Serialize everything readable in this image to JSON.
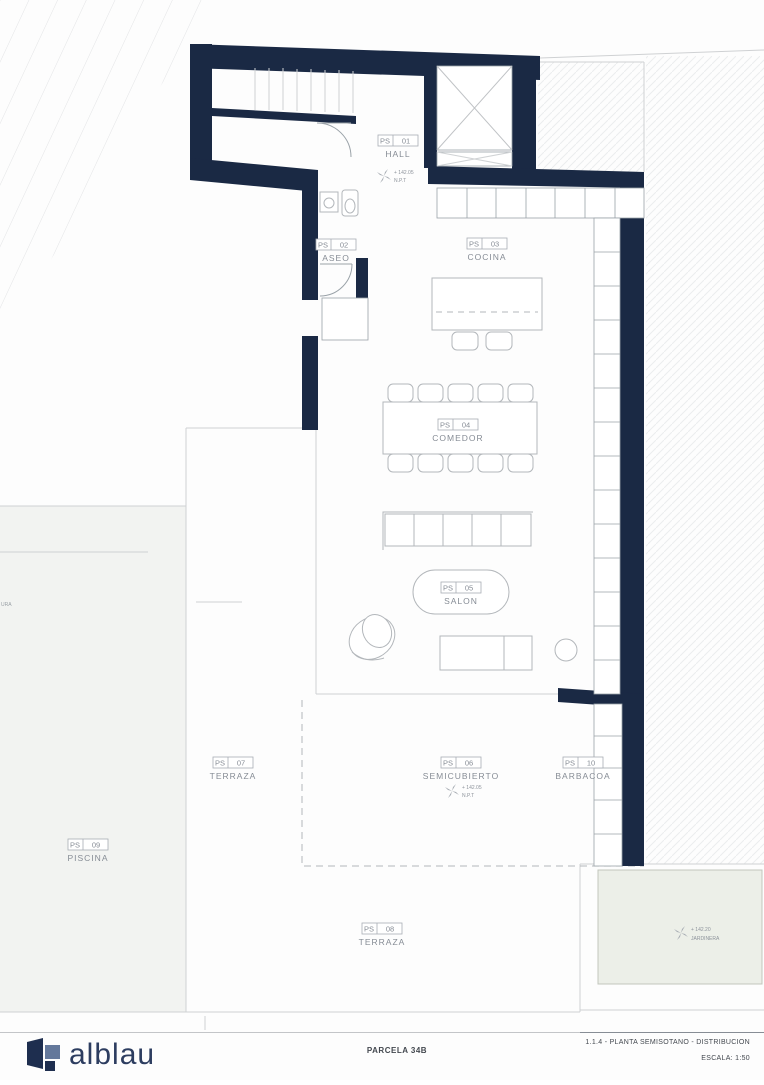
{
  "colors": {
    "wall_navy": "#1a2944",
    "brand_navy": "#2d3d60",
    "label_gray": "#868c95"
  },
  "rooms": [
    {
      "code": "PS",
      "num": "01",
      "name": "HALL"
    },
    {
      "code": "PS",
      "num": "02",
      "name": "ASEO"
    },
    {
      "code": "PS",
      "num": "03",
      "name": "COCINA"
    },
    {
      "code": "PS",
      "num": "04",
      "name": "COMEDOR"
    },
    {
      "code": "PS",
      "num": "05",
      "name": "SALON"
    },
    {
      "code": "PS",
      "num": "06",
      "name": "SEMICUBIERTO"
    },
    {
      "code": "PS",
      "num": "07",
      "name": "TERRAZA"
    },
    {
      "code": "PS",
      "num": "08",
      "name": "TERRAZA"
    },
    {
      "code": "PS",
      "num": "09",
      "name": "PISCINA"
    },
    {
      "code": "PS",
      "num": "10",
      "name": "BARBACOA"
    }
  ],
  "levels": {
    "hall": {
      "value": "+ 142.05",
      "ref": "N.P.T"
    },
    "semicubierto": {
      "value": "+ 142.05",
      "ref": "N.P.T"
    },
    "jardinera": {
      "value": "+ 142.20",
      "ref": "JARDINERA"
    }
  },
  "site": {
    "boundary_fragment": "URA"
  },
  "footer": {
    "brand": "alblau",
    "parcel": "PARCELA 34B",
    "sheet": "1.1.4 - PLANTA SEMISOTANO -  DISTRIBUCION",
    "scale": "ESCALA: 1:50"
  }
}
